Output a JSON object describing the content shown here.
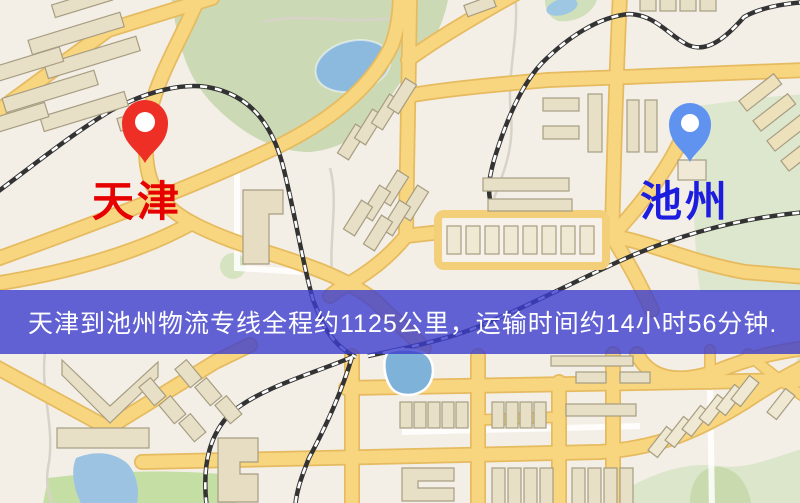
{
  "map": {
    "origin": {
      "name": "天津",
      "pin_color": "#ee2f26",
      "label_color": "#e60100"
    },
    "destination": {
      "name": "池州",
      "pin_color": "#6092f0",
      "label_color": "#1d1de0"
    },
    "banner": {
      "text": "天津到池州物流专线全程约1125公里，运输时间约14小时56分钟.",
      "background": "#3c3dce",
      "text_color": "#ffffff"
    },
    "route": {
      "distance_text": "约1125公里",
      "duration_text": "约14小时56分钟"
    },
    "palette": {
      "map_background": "#f3efe7",
      "road": "#f8d57f",
      "road_casing": "#e6bb60",
      "green_area": "#ccd9b5",
      "water": "#8cbade",
      "railway": "#333333",
      "building": "#e8e0c6"
    }
  }
}
